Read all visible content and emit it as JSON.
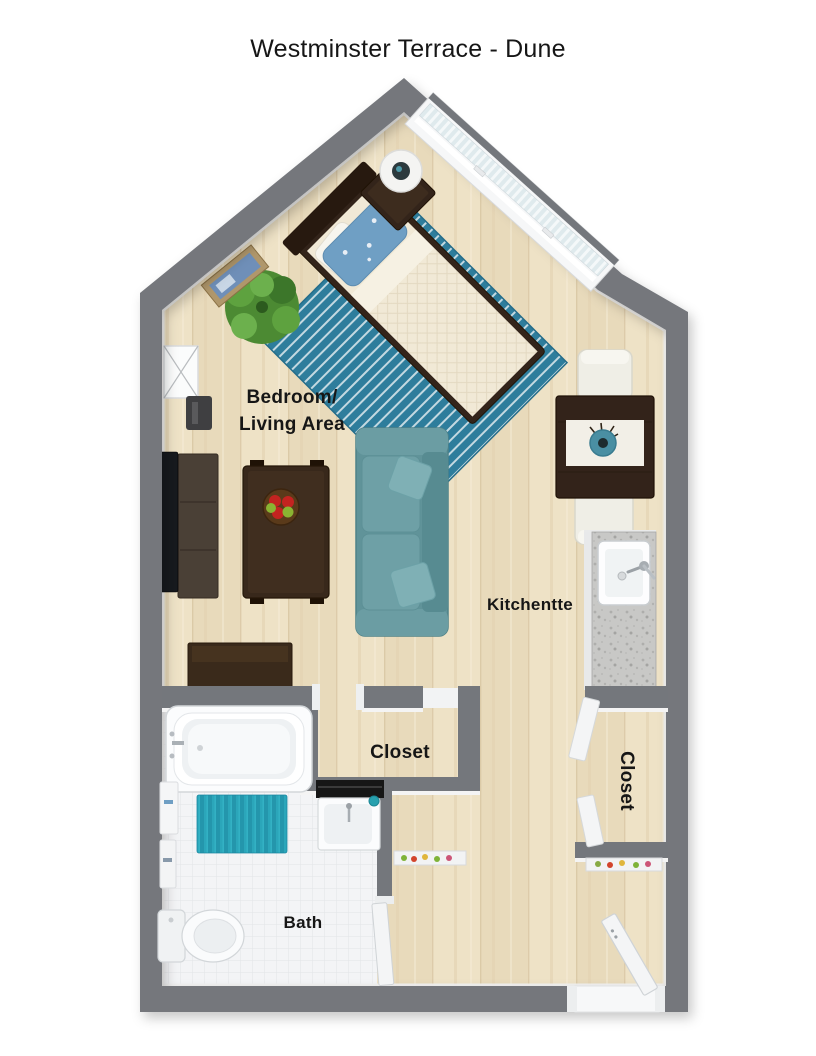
{
  "title": "Westminster Terrace - Dune",
  "rooms": {
    "bedroom_living": {
      "line1": "Bedroom/",
      "line2": "Living Area"
    },
    "kitchenette": {
      "label": "Kitchentte"
    },
    "closet_middle": {
      "label": "Closet"
    },
    "closet_right": {
      "label": "Closet"
    },
    "bath": {
      "label": "Bath"
    }
  },
  "palette": {
    "wall": "#74777c",
    "wood_floor": "#ebdec1",
    "tile_floor": "#f3f4f6",
    "rug_teal": "#2e7d9c",
    "sofa_teal": "#609399",
    "dark_wood": "#33241a",
    "granite": "#c8c8c6",
    "bath_mat_teal": "#2ba6ba",
    "label_text": "#161616"
  }
}
